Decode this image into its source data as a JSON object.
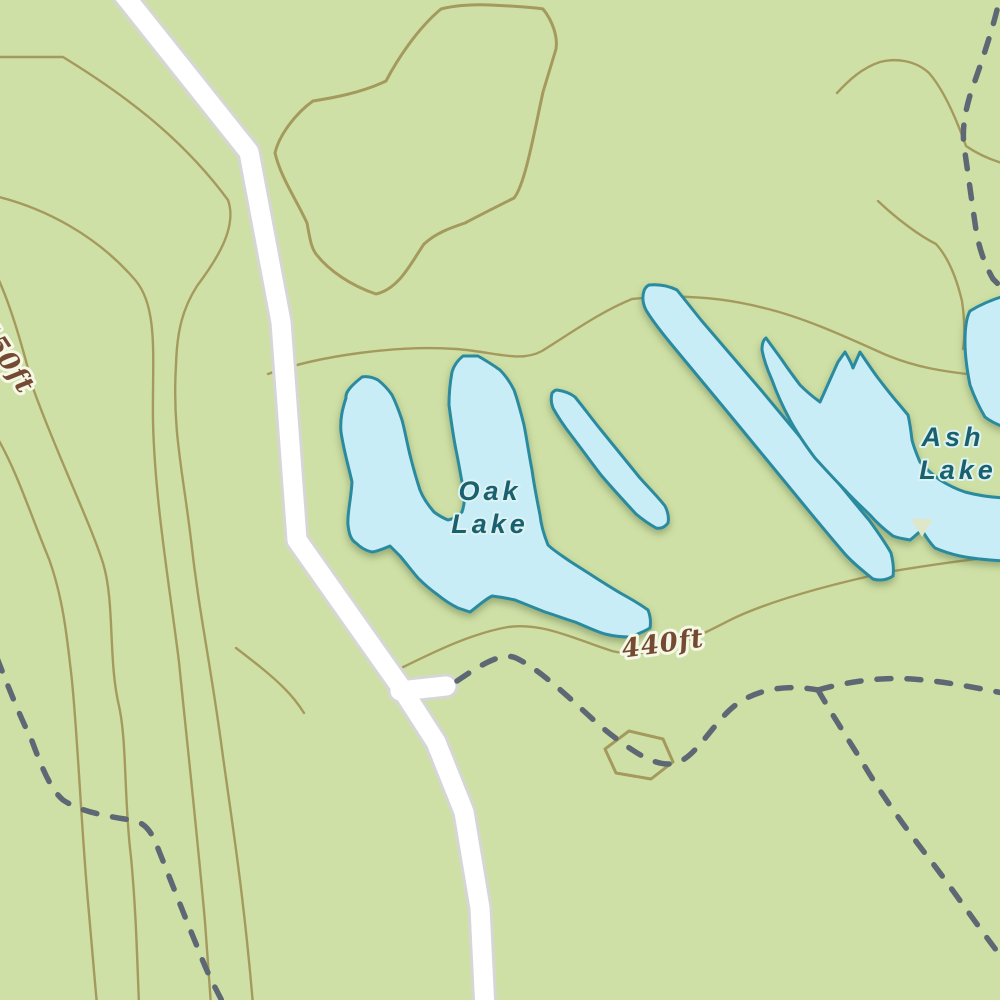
{
  "map": {
    "kind": "topographic-map-tile",
    "labels": {
      "oak_lake_line1": "Oak",
      "oak_lake_line2": "Lake",
      "ash_lake_line1": "Ash",
      "ash_lake_line2": "Lake",
      "contour_440": "440ft",
      "contour_450": "450ft"
    },
    "colors": {
      "land": "#cfe0a6",
      "water": "#c9edf6",
      "water-stroke": "#2c8a9e",
      "contour": "#a49a5e",
      "road-fill": "#ffffff",
      "road-casing": "#d6d6d6",
      "trail": "#5d6874",
      "water-label": "#19616e",
      "water-halo": "#ddf2f2",
      "contour-label": "#754a32",
      "label-halo": "#f6f8e6",
      "marker": "#dfe7c8"
    }
  }
}
